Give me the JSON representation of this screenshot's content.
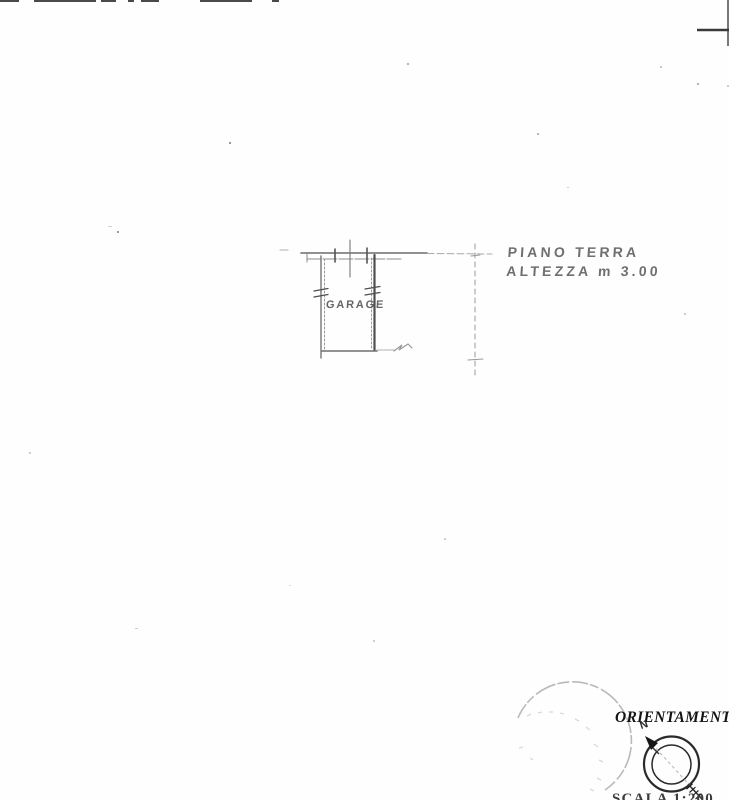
{
  "plan": {
    "room_label": "GARAGE",
    "floor_note": {
      "line1": "PIANO TERRA",
      "line2": "ALTEZZA m 3.00"
    }
  },
  "orientation": {
    "title": "ORIENTAMENTO",
    "north_label": "N"
  },
  "footer": {
    "cutoff_scale_text": "SCALA 1:200"
  },
  "colors": {
    "paper": "#fefefe",
    "pencil_line": "#6f6f6f",
    "dark_wall": "#4f4f4f",
    "hand_text": "#4c4c4c",
    "ink": "#161616",
    "stamp": "#9c9c9c"
  }
}
